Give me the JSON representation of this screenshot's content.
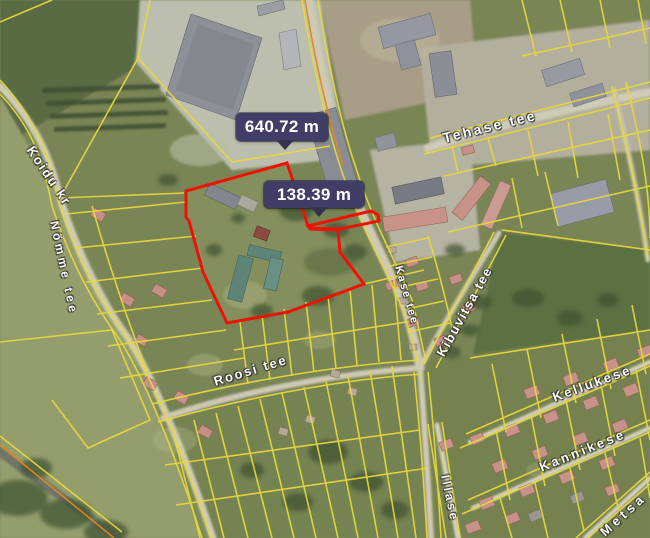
{
  "map": {
    "measurement_tooltips": [
      {
        "value": "640.72 m"
      },
      {
        "value": "138.39 m"
      }
    ],
    "street_labels": [
      {
        "name": "Koidu kr"
      },
      {
        "name": "Nõmme tee"
      },
      {
        "name": "Tehase tee"
      },
      {
        "name": "Kase tee"
      },
      {
        "name": "Kibuvitsa tee"
      },
      {
        "name": "Roosi tee"
      },
      {
        "name": "Kellukese"
      },
      {
        "name": "Kannikese"
      },
      {
        "name": "Illase"
      },
      {
        "name": "Metsa"
      }
    ],
    "colors": {
      "cadastral_line": "#e8d83e",
      "road_casing": "#e0891c",
      "selected_parcel_outline": "#ee1205",
      "tooltip_bg": "#403e66",
      "tooltip_text": "#ffffff"
    }
  }
}
